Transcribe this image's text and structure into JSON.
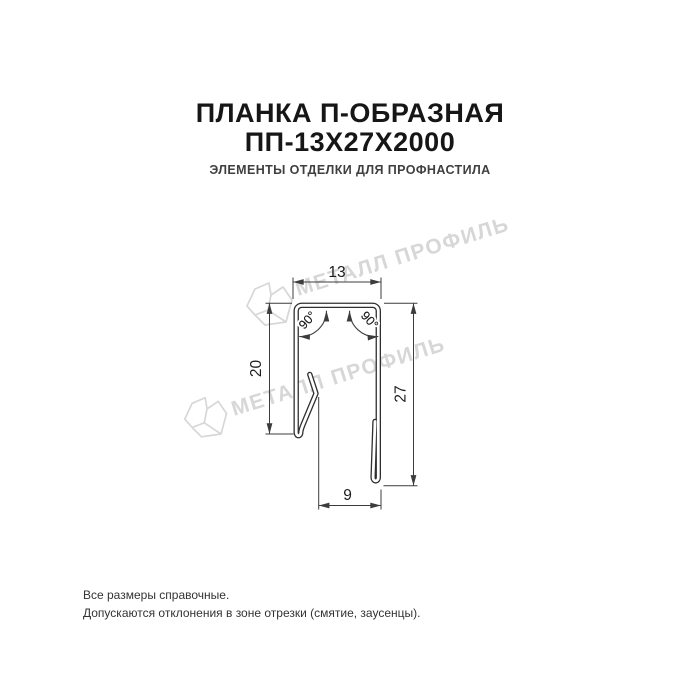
{
  "header": {
    "title_line1": "ПЛАНКА П-ОБРАЗНАЯ",
    "title_line2": "ПП-13Х27Х2000",
    "subtitle": "ЭЛЕМЕНТЫ ОТДЕЛКИ ДЛЯ ПРОФНАСТИЛА"
  },
  "drawing": {
    "dim_top_width": "13",
    "dim_left_height": "20",
    "dim_right_height": "27",
    "dim_bottom_width": "9",
    "angle_left": "90°",
    "angle_right": "90°"
  },
  "watermark": {
    "text": "МЕТАЛЛ ПРОФИЛЬ"
  },
  "footer": {
    "line1": "Все размеры справочные.",
    "line2": "Допускаются отклонения в зоне отрезки (смятие, заусенцы)."
  },
  "colors": {
    "title": "#161616",
    "subtitle": "#3f3f3f",
    "drawing_line": "#2f2f2f",
    "dimension_line": "#3c3c3c",
    "watermark": "#d7d7d7",
    "background": "#ffffff"
  }
}
